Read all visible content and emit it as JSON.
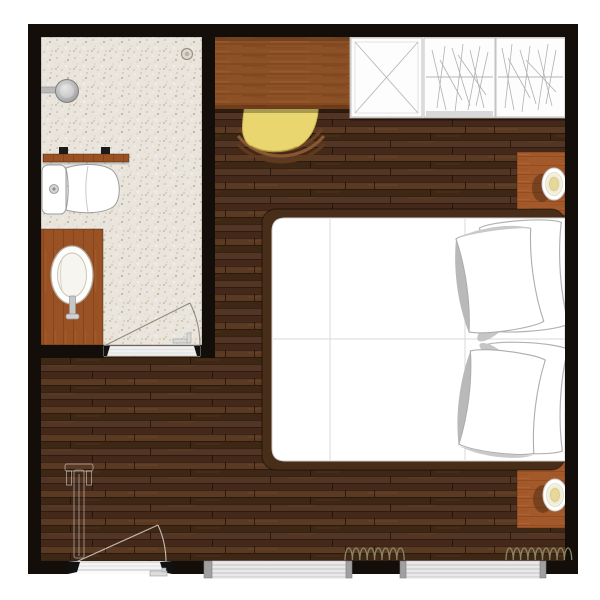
{
  "scene": {
    "kind": "architectural floor plan",
    "room_type": "hotel bedroom with en-suite bathroom"
  },
  "palette": {
    "wall": "#130e09",
    "bedroom_floor": "#4d3120",
    "bathroom_floor": "#e9e5dc",
    "desk_wood": "#8d5126",
    "vanity_wood": "#9a5224",
    "nightstand_wood": "#a3592a",
    "chair_seat": "#e9d66f",
    "mattress": "#ffffff",
    "curtain": "#8a8660",
    "window_frame": "#e9e9e9",
    "swing_line_light": "#e6dfd3",
    "swing_line_dark": "#7a756b"
  },
  "rooms": {
    "bathroom": "Bathroom",
    "bedroom": "Bedroom"
  },
  "furniture": {
    "desk": "Desk",
    "chair": "Desk chair",
    "wardrobe": "Wardrobe",
    "wardrobe_shelf_unit": "Wardrobe shelf unit",
    "wardrobe_rail_unit": "Wardrobe hanging-rail unit",
    "nightstand_top": "Nightstand with lamp",
    "nightstand_bottom": "Nightstand with lamp",
    "bed": "Double bed",
    "pillows": "Pillows",
    "luggage_rack": "Luggage rack",
    "shower": "Shower head",
    "drain": "Floor drain",
    "shelf": "Bathroom shelf",
    "toilet": "Toilet",
    "vanity": "Vanity unit",
    "sink": "Washbasin",
    "entry_door": "Entrance door",
    "bath_door": "Bathroom door",
    "window_1": "Window",
    "window_2": "Window",
    "curtains": "Curtains"
  }
}
